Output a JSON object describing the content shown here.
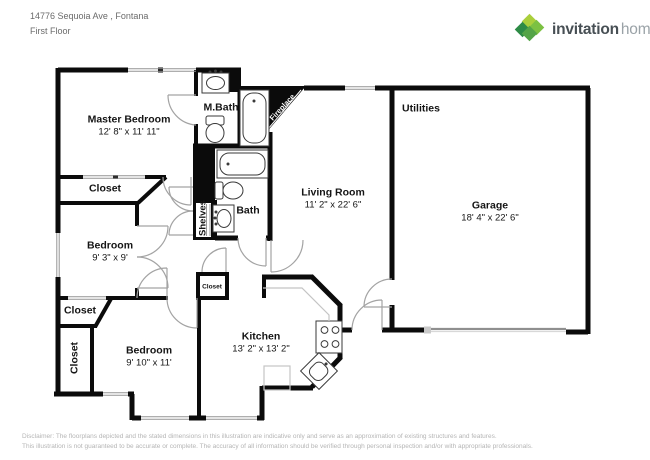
{
  "header": {
    "address": "14776 Sequoia Ave , Fontana",
    "floor": "First Floor"
  },
  "logo": {
    "brand_bold": "invitation",
    "brand_light": "homes",
    "icon": "pinwheel-leaf-icon",
    "colors": {
      "leaf_light": "#aacf3c",
      "leaf_green": "#7cc142",
      "leaf_dark": "#2e8b46",
      "leaf_mid": "#54a447",
      "brand_bold_text": "#474f54",
      "brand_light_text": "#9aa2a7"
    }
  },
  "rooms": {
    "master_bedroom": {
      "label": "Master Bedroom",
      "dims": "12' 8\" x 11' 11\""
    },
    "m_bath": {
      "label": "M.Bath"
    },
    "bath": {
      "label": "Bath"
    },
    "shelves": {
      "label": "Shelves"
    },
    "fireplace": {
      "label": "Fireplace"
    },
    "living_room": {
      "label": "Living Room",
      "dims": "11' 2\" x 22' 6\""
    },
    "utilities": {
      "label": "Utilities"
    },
    "garage": {
      "label": "Garage",
      "dims": "18' 4\" x 22' 6\""
    },
    "closet_master": {
      "label": "Closet"
    },
    "bedroom_1": {
      "label": "Bedroom",
      "dims": "9' 3\" x 9'"
    },
    "closet_hall": {
      "label": "Closet"
    },
    "closet_bedroom_2": {
      "label": "Closet"
    },
    "bedroom_2": {
      "label": "Bedroom",
      "dims": "9' 10\" x 11'"
    },
    "closet_kitchen": {
      "label": "Closet"
    },
    "kitchen": {
      "label": "Kitchen",
      "dims": "13' 2\" x 13' 2\""
    }
  },
  "plan_colors": {
    "wall": "#0b0b0b",
    "window_line": "#949494",
    "door_arc": "#a3a3a3",
    "fixture_line": "#3a3a3a",
    "counter_line": "#c4c4c4"
  },
  "disclaimer": {
    "line1": "Disclaimer: The floorplans depicted and the stated dimensions in this illustration are indicative only and serve as an approximation of existing structures and features.",
    "line2": "This illustration is not guaranteed to be accurate or complete. The accuracy of all information should be verified through personal inspection and/or with appropriate professionals."
  }
}
